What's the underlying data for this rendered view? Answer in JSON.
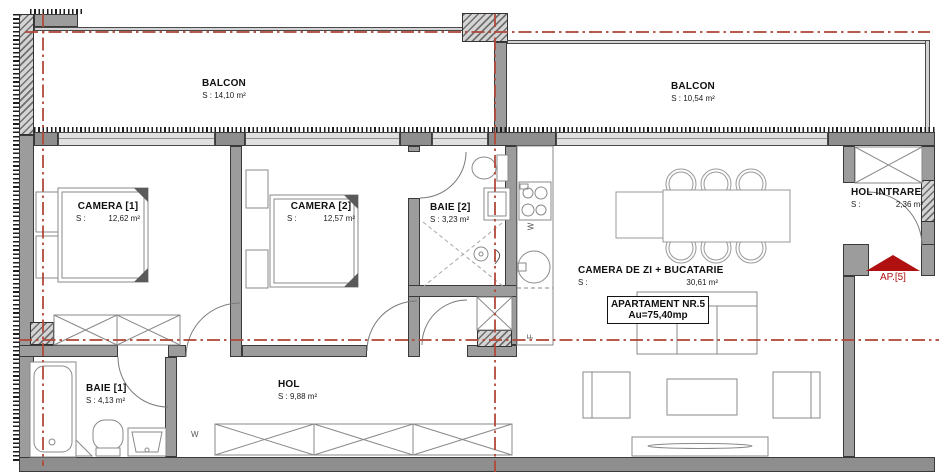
{
  "balconies": {
    "b1": {
      "name": "BALCON",
      "area": "S : 14,10 m²"
    },
    "b2": {
      "name": "BALCON",
      "area": "S : 10,54 m²"
    }
  },
  "rooms": {
    "camera1": {
      "name": "CAMERA [1]",
      "s": "S :",
      "area": "12,62 m²"
    },
    "camera2": {
      "name": "CAMERA [2]",
      "s": "S :",
      "area": "12,57 m²"
    },
    "baie2": {
      "name": "BAIE [2]",
      "area": "S : 3,23 m²"
    },
    "living": {
      "name": "CAMERA DE ZI + BUCATARIE",
      "s": "S :",
      "area": "30,61 m²"
    },
    "hol_intrare": {
      "name": "HOL INTRARE",
      "s": "S :",
      "area": "2,36 m²"
    },
    "baie1": {
      "name": "BAIE [1]",
      "area": "S : 4,13 m²"
    },
    "hol": {
      "name": "HOL",
      "area": "S : 9,88 m²"
    }
  },
  "apartment_box": {
    "line1": "APARTAMENT NR.5",
    "line2": "Au=75,40mp"
  },
  "entrance_arrow": {
    "label": "AP.[5]"
  },
  "appliance_labels": {
    "washer_kitchen": "W",
    "fridge": "F",
    "washer_hol": "W"
  },
  "colors": {
    "wall": "#9c9c9c",
    "window": "#e0e0e0",
    "axis_red": "#b0493a",
    "arrow_red": "#b01010",
    "furniture_line": "#8a8a8a"
  }
}
